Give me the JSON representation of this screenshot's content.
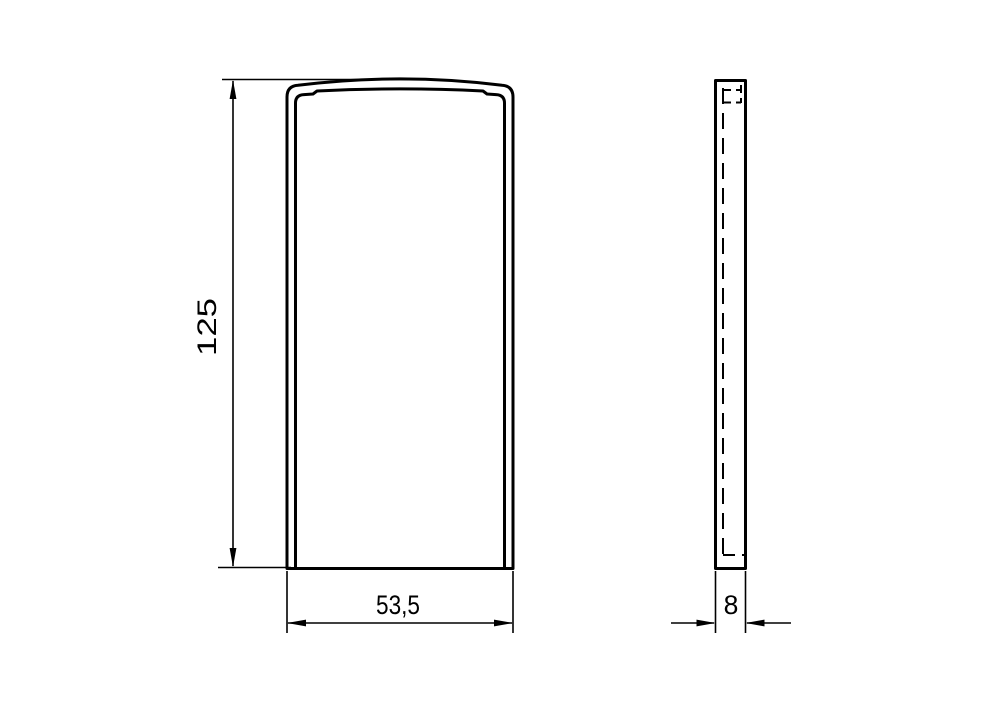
{
  "drawing": {
    "background_color": "#ffffff",
    "line_color": "#000000",
    "views": {
      "front_view": {
        "name": "front view"
      },
      "side_view": {
        "name": "side view"
      }
    },
    "dimensions": {
      "height": {
        "label": "125",
        "orientation": "vertical"
      },
      "width": {
        "label": "53,5",
        "orientation": "horizontal"
      },
      "thickness": {
        "label": "8",
        "orientation": "horizontal"
      }
    }
  }
}
